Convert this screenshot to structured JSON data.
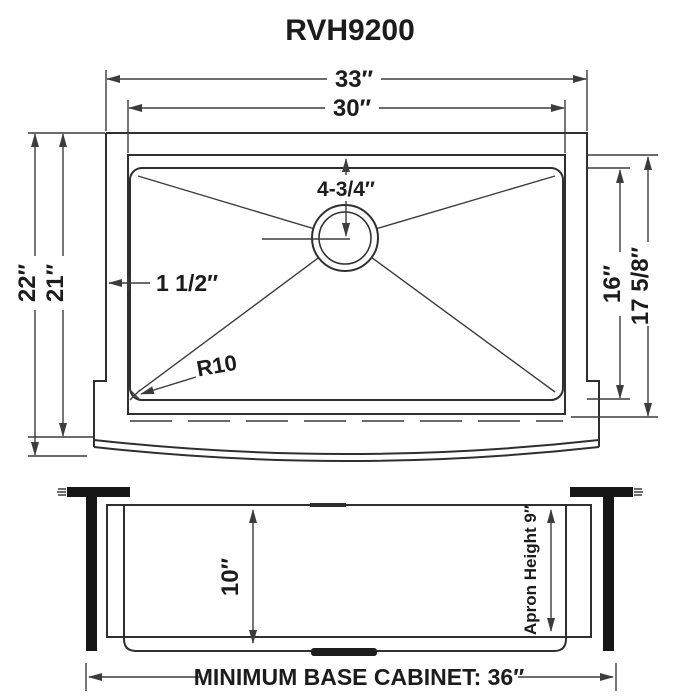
{
  "title": "RVH9200",
  "colors": {
    "line": "#2f2f2f",
    "dim_line": "#3c3c3c",
    "text": "#1c1c1c",
    "solid_black": "#161616"
  },
  "top_view": {
    "overall_width": "33″",
    "bowl_width": "30″",
    "overall_depth": "22″",
    "inner_depth": "21″",
    "bowl_front_to_back": "16″",
    "rim_front_to_back": "17 5/8″",
    "drain_offset": "4-3/4″",
    "rim_width": "1 1/2″",
    "corner_radius": "R10"
  },
  "front_view": {
    "bowl_height": "10″",
    "apron_height": "Apron Height  9″",
    "base_cabinet_note": "MINIMUM BASE CABINET: 36″"
  }
}
